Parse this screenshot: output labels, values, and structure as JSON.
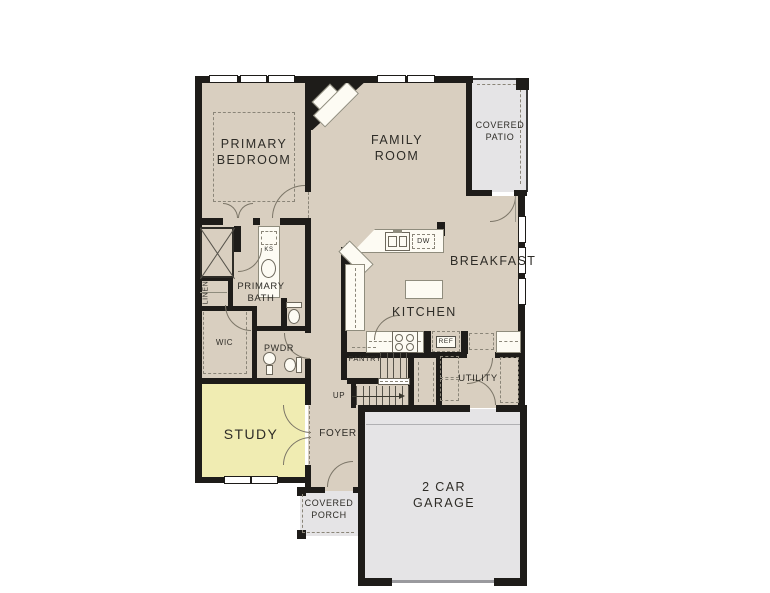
{
  "plan_title": "First Floor Plan",
  "rooms": {
    "primary_bedroom": "PRIMARY BEDROOM",
    "family_room": "FAMILY ROOM",
    "covered_patio": "COVERED PATIO",
    "breakfast": "BREAKFAST",
    "kitchen": "KITCHEN",
    "primary_bath": "PRIMARY BATH",
    "linen": "LINEN",
    "wic": "WIC",
    "pwdr": "PWDR",
    "study": "STUDY",
    "foyer": "FOYER",
    "pantry": "PANTRY",
    "utility": "UTILITY",
    "garage": "2 CAR GARAGE",
    "covered_porch": "COVERED PORCH"
  },
  "fixtures": {
    "ks": "KS",
    "dw": "DW",
    "ref": "REF",
    "up": "UP"
  },
  "colors": {
    "wall": "#1e1c19",
    "floor": "#d9cfc0",
    "study": "#f0ecb2",
    "concrete": "#e5e4e6",
    "counter": "#fdfbf3",
    "line": "#8a8578",
    "text": "#2e2c27"
  }
}
